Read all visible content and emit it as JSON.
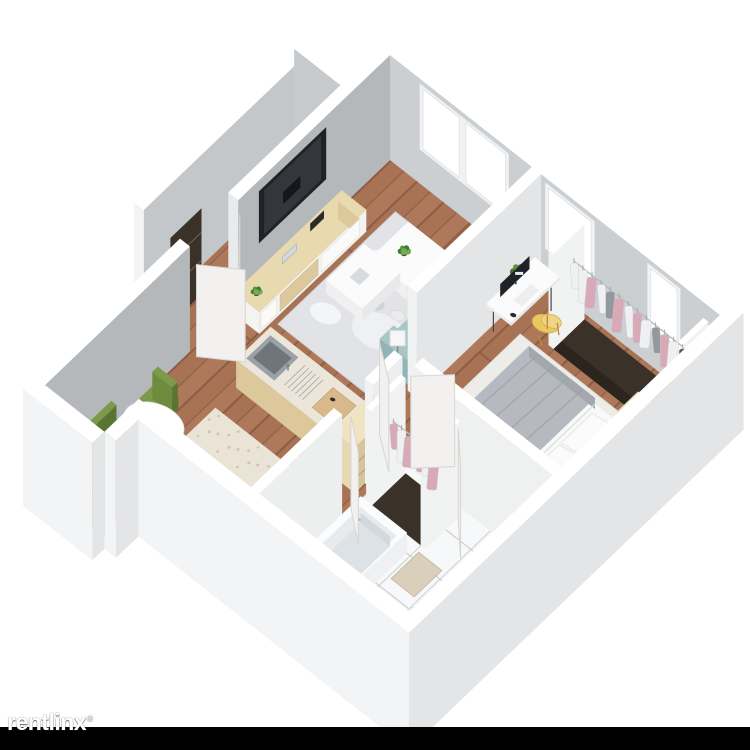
{
  "page": {
    "background": "#ffffff"
  },
  "watermark": {
    "text": "rentlinx",
    "mark": "®",
    "bar_color": "#000000",
    "text_color": "#ffffff"
  },
  "floor_plan": {
    "view": "3d-isometric-cutaway",
    "unit_type": "one-bedroom one-bath apartment",
    "rooms": [
      {
        "name": "entry-hall",
        "floor": "wood",
        "features": [
          "open-double-entry-door",
          "dark-entry-closet"
        ]
      },
      {
        "name": "living-room",
        "floor": "wood",
        "features": [
          "wall-mounted-tv",
          "media-console",
          "area-rug",
          "teal-sofa",
          "two-coffee-tables",
          "floor-lamp",
          "potted-plants",
          "two-windows"
        ]
      },
      {
        "name": "dining-nook",
        "floor": "wood",
        "features": [
          "round-white-table",
          "three-green-chairs",
          "table-plant"
        ]
      },
      {
        "name": "kitchen",
        "floor": "beige-tile",
        "features": [
          "island-with-steel-sink",
          "dish-rack",
          "cutting-board",
          "counter-sink-with-dishes",
          "four-burner-gas-stove"
        ]
      },
      {
        "name": "bedroom",
        "floor": "wood",
        "features": [
          "double-bed-gray-blanket",
          "white-bed-rug",
          "two-wood-nightstands",
          "desk-with-monitor",
          "yellow-chair",
          "open-closet-hanging-clothes",
          "window"
        ]
      },
      {
        "name": "hallway",
        "floor": "wood",
        "features": [
          "wood-shelf-cabinet",
          "closet-with-pink-clothes"
        ]
      },
      {
        "name": "bathroom",
        "floor": "white-tile",
        "features": [
          "bathtub",
          "toilet",
          "vanity-sink",
          "beige-bath-mat"
        ]
      }
    ],
    "closet_garments": {
      "bedroom_closet": [
        "white",
        "white",
        "pink",
        "white",
        "gray",
        "pink",
        "white",
        "pink",
        "white",
        "gray",
        "pink",
        "white",
        "dark"
      ],
      "hall_closet": [
        "pink",
        "white",
        "pink",
        "pink",
        "white",
        "pink"
      ]
    },
    "palette": {
      "wallTop": "#ffffff",
      "wallNW": "#b4b8bb",
      "wallNE": "#cbcfd2",
      "wallInner": "#e9eaeb",
      "wallInnerLight": "#f1f2f2",
      "wallExt": "#f3f4f5",
      "wallExtShade": "#e3e5e7",
      "woodBase": "#a87355",
      "woodDark": "#8d5c44",
      "woodLight": "#b5805f",
      "kitchenTile": "#eae4d7",
      "kitchenSpeck": "#cfc6b1",
      "bathTile": "#f7f8f9",
      "bathGrout": "#c7ccd1",
      "sofa": "#93b4b6",
      "sofaDark": "#7da2a5",
      "sofaLight": "#a9c6c7",
      "rug": "#e1e3e7",
      "rugLight": "#f4f5f7",
      "furnWhite": "#fbfbfb",
      "furnWhiteSide": "#e9e9e9",
      "consoleWood": "#e8d9ae",
      "consoleWoodSide": "#dcc89b",
      "tv": "#1f2226",
      "tvScreen": "#33373d",
      "bedWhite": "#f6f6f7",
      "bedSide": "#e8e8ea",
      "blanket": "#b6bac0",
      "blanketDark": "#a3a8af",
      "bedFrame": "#4e4237",
      "nightstand": "#ddc9a1",
      "olive": "#6f8c3e",
      "oliveDark": "#5a7431",
      "yellow": "#e9c85f",
      "plantGreen": "#57953f",
      "plantGreenDark": "#3f7a2f",
      "plantGreenLight": "#73ac56",
      "pot": "#4a423a",
      "steel": "#9aa2a8",
      "steelDark": "#6e757b",
      "board": "#d9b98a",
      "darkWood": "#3a3128",
      "clothWhite": "#eff0f2",
      "clothPink": "#d8a9b6",
      "clothGray": "#94989e",
      "clothDark": "#54575d",
      "rail": "#b9bdc0",
      "door": "#f2f1ef",
      "doorEdge": "#d7d5d1",
      "mat": "#d9cfba",
      "burner": "#33373b"
    },
    "windows": [
      {
        "room": "living-room",
        "label": "window-1"
      },
      {
        "room": "living-room",
        "label": "window-2"
      },
      {
        "room": "bedroom",
        "label": "window-3"
      },
      {
        "room": "bedroom",
        "label": "window-4"
      }
    ]
  }
}
